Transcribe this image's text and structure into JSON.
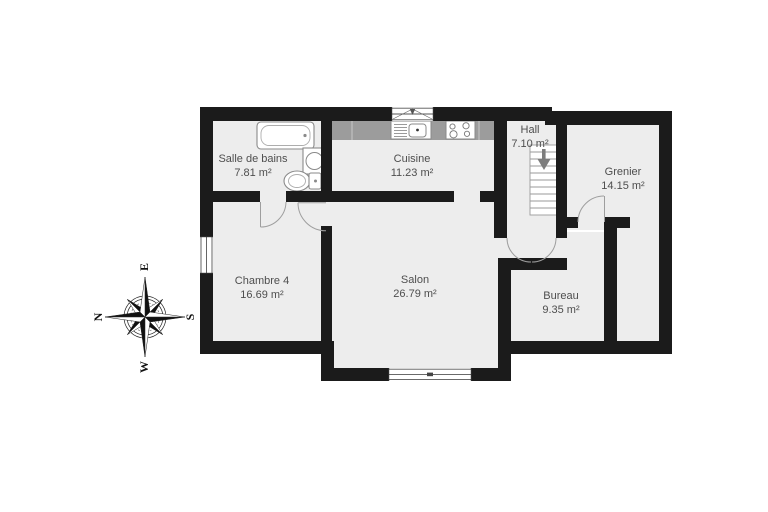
{
  "plan": {
    "title": "floor-plan",
    "rooms": [
      {
        "id": "salle-de-bains",
        "name": "Salle de bains",
        "area": "7.81 m²"
      },
      {
        "id": "cuisine",
        "name": "Cuisine",
        "area": "11.23 m²"
      },
      {
        "id": "hall",
        "name": "Hall",
        "area": "7.10 m²"
      },
      {
        "id": "grenier",
        "name": "Grenier",
        "area": "14.15 m²"
      },
      {
        "id": "chambre-4",
        "name": "Chambre 4",
        "area": "16.69 m²"
      },
      {
        "id": "salon",
        "name": "Salon",
        "area": "26.79 m²"
      },
      {
        "id": "bureau",
        "name": "Bureau",
        "area": "9.35 m²"
      }
    ],
    "compass": {
      "north": "N",
      "east": "E",
      "south": "S",
      "west": "W"
    },
    "fixtures": [
      "bathtub",
      "washbasin",
      "toilet",
      "kitchen-sink",
      "stove",
      "staircase-down",
      "double-door",
      "windows"
    ],
    "colors": {
      "wall": "#1b1b1b",
      "floor": "#ededed",
      "counter": "#9c9c9c",
      "label": "#4e4e4e",
      "fixture_stroke": "#8a8a8a",
      "door_arc": "#9e9e9e",
      "stair_arrow": "#7d7d7d"
    }
  }
}
